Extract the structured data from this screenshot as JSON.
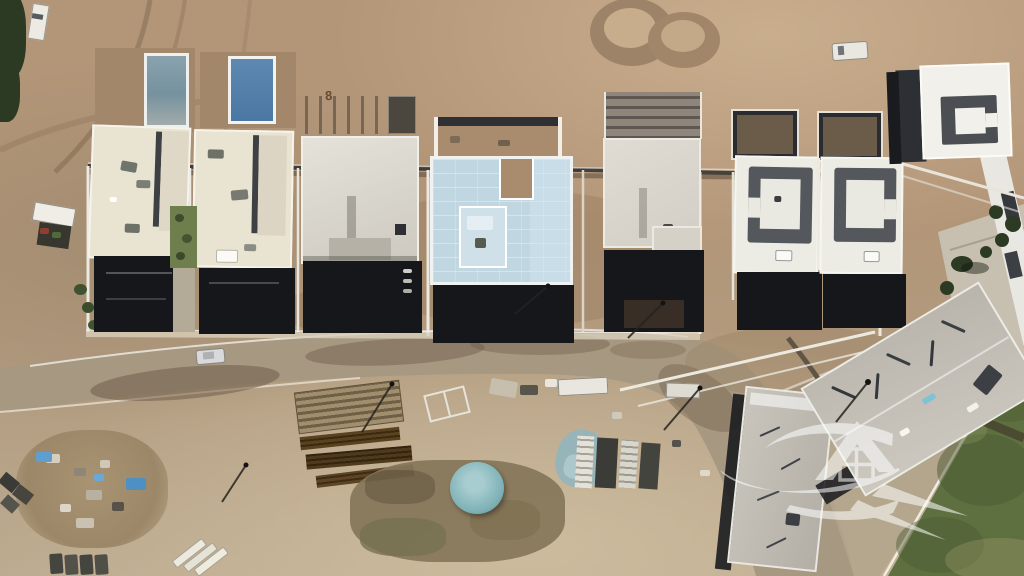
{
  "ground_marking": {
    "lot_number": "8"
  },
  "watermark": {
    "icon": "house-sail-logo",
    "opacity": 0.55
  },
  "colors": {
    "dirt": "#b39678",
    "dirtLight": "#c9ae8e",
    "dirtDark": "#9a7f64",
    "deck": "#a3876a",
    "sand": "#cdbb9e",
    "road": "#a79881",
    "roadLight": "#b3a58d",
    "wet": "#6f5d49",
    "roofCream": "#e9e3d2",
    "roofWhite": "#edece4",
    "concrete": "#cdc9c0",
    "concreteDark": "#b7b3aa",
    "blueRoof": "#c0d7e2",
    "blueCourt": "#cfe0e8",
    "pool1a": "#8aa2ae",
    "pool1b": "#75929f",
    "pool2a": "#5e88b0",
    "pool2b": "#4a78a2",
    "shadow": "#16171b",
    "structDark": "#54585c",
    "lawn": "#5f7040",
    "lawnDark": "#4a5a32",
    "tree": "#2c3a24",
    "teal": "#7fb2b7",
    "blueTarp": "#5f9fd0",
    "timber": "#4d3920",
    "mound": "#86775a",
    "white": "#f1efe8",
    "scaffold": "#90857a"
  }
}
